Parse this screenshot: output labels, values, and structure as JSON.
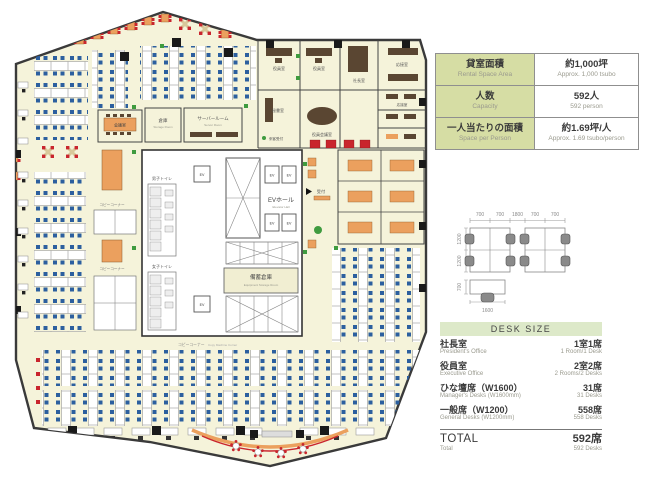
{
  "panel": {
    "spec_table": {
      "rows": [
        {
          "label_jp": "貸室面積",
          "label_en": "Rental Space Area",
          "value_jp": "約1,000坪",
          "value_en": "Approx. 1,000 tsubo"
        },
        {
          "label_jp": "人数",
          "label_en": "Capacity",
          "value_jp": "592人",
          "value_en": "592 person"
        },
        {
          "label_jp": "一人当たりの面積",
          "label_en": "Space per Person",
          "value_jp": "約1.69坪/人",
          "value_en": "Approx. 1.69 tsubo/person"
        }
      ]
    },
    "desk_diagram": {
      "dims_top": [
        "700",
        "700",
        "1800",
        "700",
        "700"
      ],
      "dims_left": [
        "1200",
        "1200"
      ],
      "single_desk": {
        "height": "700",
        "width": "1600"
      }
    },
    "desk_size_table": {
      "title": "DESK SIZE",
      "rows": [
        {
          "label_jp": "社長室",
          "label_en": "President's Office",
          "value_jp": "1室1席",
          "value_en": "1 Room/1 Desk"
        },
        {
          "label_jp": "役員室",
          "label_en": "Executive Office",
          "value_jp": "2室2席",
          "value_en": "2 Rooms/2 Desks"
        },
        {
          "label_jp": "ひな壇席（W1600）",
          "label_en": "Manager's Desks (W1600mm)",
          "value_jp": "31席",
          "value_en": "31 Desks"
        },
        {
          "label_jp": "一般席（W1200）",
          "label_en": "General Desks (W1200mm)",
          "value_jp": "558席",
          "value_en": "558 Desks"
        }
      ],
      "total": {
        "label_jp": "TOTAL",
        "label_en": "Total",
        "value_jp": "592席",
        "value_en": "592 Desks"
      }
    }
  },
  "floorplan": {
    "labels": {
      "ev_hall_jp": "EVホール",
      "ev_hall_en": "Elevator Hall",
      "reserve_jp": "備蓄倉庫",
      "reserve_en": "Equipment Storage Room",
      "mens_toilet_jp": "男子トイレ",
      "womens_toilet_jp": "女子トイレ",
      "meeting_room_jp": "会議室",
      "storage_jp": "倉庫",
      "storage_en": "Storage Room",
      "server_jp": "サーバールーム",
      "server_en": "Server Room",
      "exec_jp": "役員室",
      "president_jp": "社長室",
      "secretary_jp": "秘書室",
      "exec_meeting_jp": "役員会議室",
      "reception_room_jp": "応接室",
      "visitor_reception_jp": "来客受付",
      "reception_desk_jp": "受付",
      "meeting_space_jp": "ミーティングスペース",
      "meeting_space_en": "Meeting Space",
      "copy_jp": "コピーコーナー",
      "copy_en": "Copy Machine Corner",
      "ev": "EV"
    },
    "colors": {
      "floor": "#f5f3da",
      "wall": "#3a3a3a",
      "chair_blue": "#2c5f9f",
      "chair_red": "#c9252d",
      "table_orange": "#eba05e",
      "green_plant": "#3f9b3f",
      "table_green": "#d6dda4",
      "header_green": "#dde9c9"
    }
  }
}
